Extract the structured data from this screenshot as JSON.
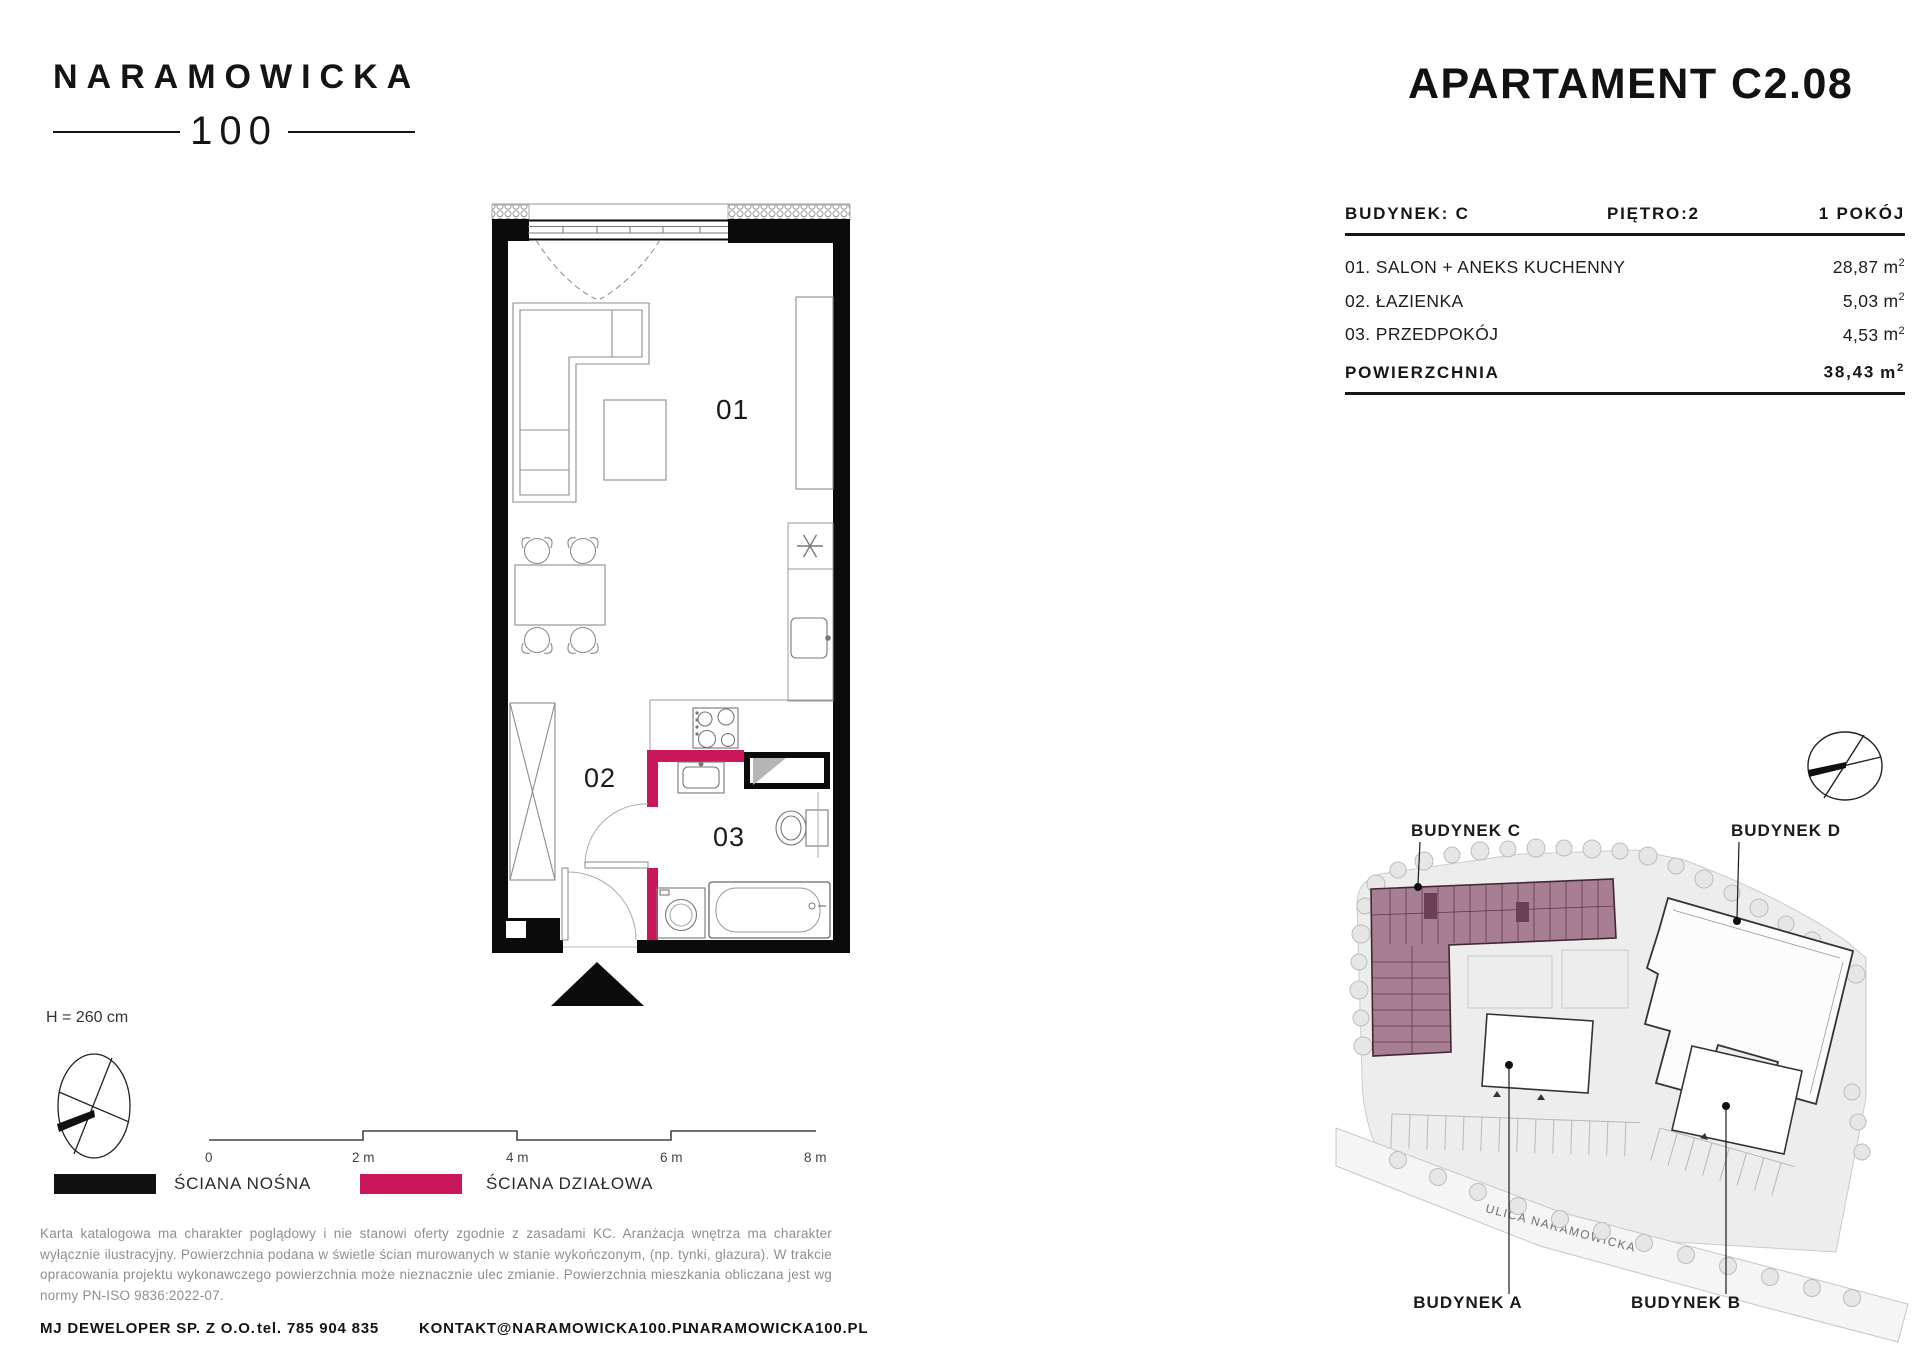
{
  "logo": {
    "name": "NARAMOWICKA",
    "number": "100"
  },
  "title": "APARTAMENT C2.08",
  "unit_table": {
    "building_label": "BUDYNEK: C",
    "floor_label": "PIĘTRO:2",
    "rooms_label": "1 POKÓJ",
    "unit_base": "m",
    "unit_sup": "2",
    "rooms": [
      {
        "name": "01. SALON + ANEKS KUCHENNY",
        "area": "28,87"
      },
      {
        "name": "02. ŁAZIENKA",
        "area": "5,03"
      },
      {
        "name": "03. PRZEDPOKÓJ",
        "area": "4,53"
      }
    ],
    "total_label": "POWIERZCHNIA",
    "total_area": "38,43"
  },
  "floor_plan": {
    "room_labels": [
      "01",
      "02",
      "03"
    ],
    "height_note": "H = 260 cm",
    "scale_ticks": [
      "0",
      "2 m",
      "4 m",
      "6 m",
      "8 m"
    ]
  },
  "legend": [
    {
      "label": "ŚCIANA NOŚNA",
      "color": "#111111"
    },
    {
      "label": "ŚCIANA DZIAŁOWA",
      "color": "#C9175C"
    }
  ],
  "disclaimer": "Karta katalogowa ma charakter poglądowy i nie stanowi oferty zgodnie z zasadami KC. Aranżacja wnętrza ma charakter wyłącznie ilustracyjny. Powierzchnia podana w świetle ścian murowanych w stanie wykończonym, (np. tynki, glazura). W trakcie opracowania projektu wykonawczego powierzchnia może nieznacznie ulec zmianie. Powierzchnia mieszkania obliczana jest wg normy PN-ISO 9836:2022-07.",
  "footer": {
    "company": "MJ DEWELOPER SP. Z O.O.",
    "phone": "tel. 785 904 835",
    "email": "KONTAKT@NARAMOWICKA100.PL",
    "website": "NARAMOWICKA100.PL"
  },
  "site_plan": {
    "buildings": [
      "BUDYNEK C",
      "BUDYNEK D",
      "BUDYNEK A",
      "BUDYNEK B"
    ],
    "street": "ULICA NARAMOWICKA"
  },
  "colors": {
    "accent": "#C9175C",
    "wall": "#0B0B0B",
    "highlight": "#A3768B"
  }
}
